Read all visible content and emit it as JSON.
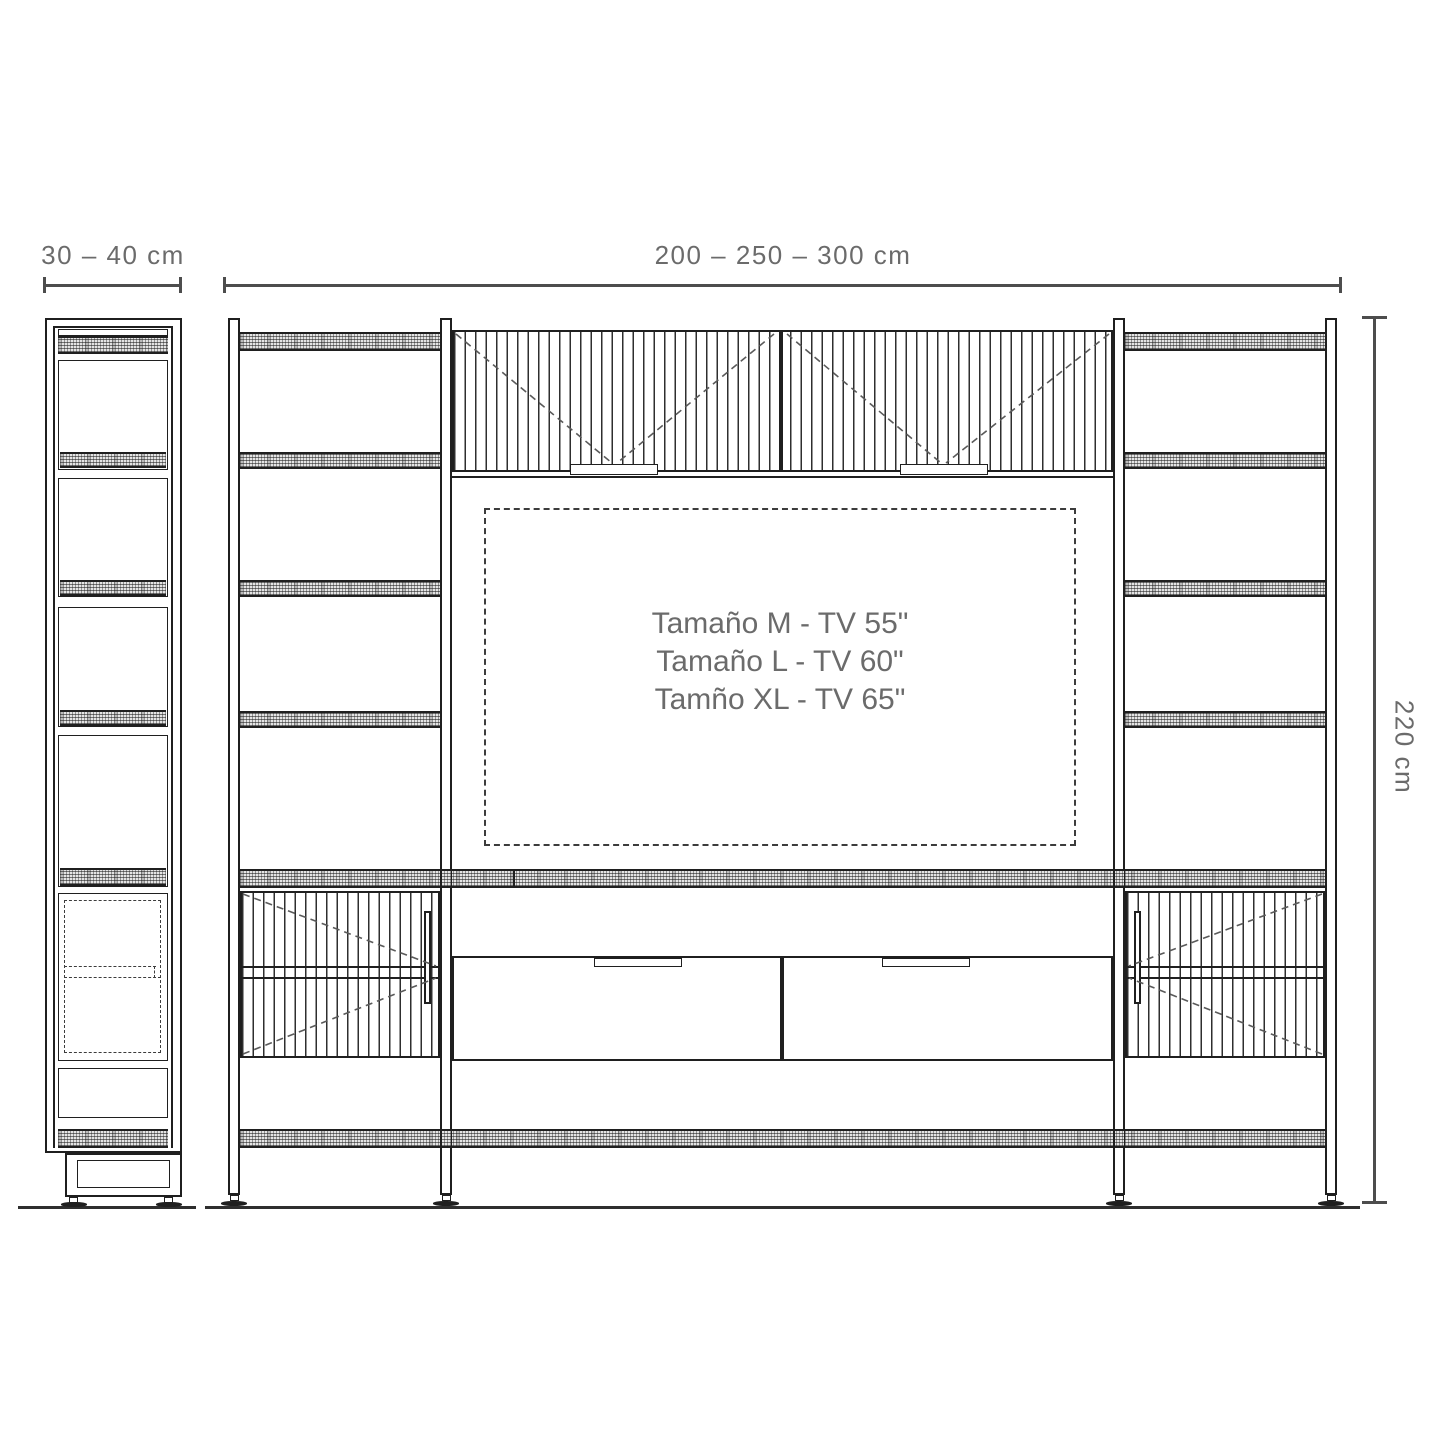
{
  "dimensions": {
    "side_width_label": "30 – 40 cm",
    "front_width_label": "200 – 250 – 300 cm",
    "height_label": "220 cm"
  },
  "tv_area": {
    "lines": [
      "Tamaño M - TV 55\"",
      "Tamaño L - TV 60\"",
      "Tamño XL - TV 65\""
    ]
  },
  "colors": {
    "line": "#1f1f1f",
    "dimension_line": "#4d4d4d",
    "text": "#6b6b6b"
  }
}
